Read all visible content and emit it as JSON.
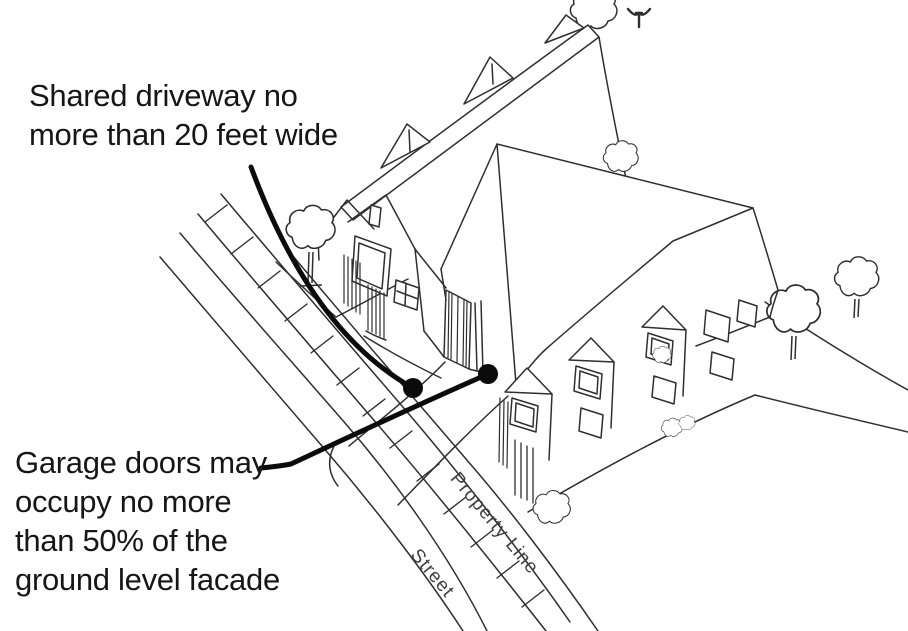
{
  "annotations": {
    "shared_driveway": {
      "lines": [
        "Shared driveway no",
        "more than 20 feet wide"
      ]
    },
    "garage_doors": {
      "lines": [
        "Garage doors may",
        "occupy no more",
        "than 50% of the",
        "ground level facade"
      ]
    }
  },
  "map_labels": {
    "property_line": "Property Line",
    "street": "Street"
  },
  "colors": {
    "background": "#ffffff",
    "ink": "#2f2f2f",
    "text": "#161616",
    "label": "#404040",
    "leader": "#0b0b0b"
  }
}
